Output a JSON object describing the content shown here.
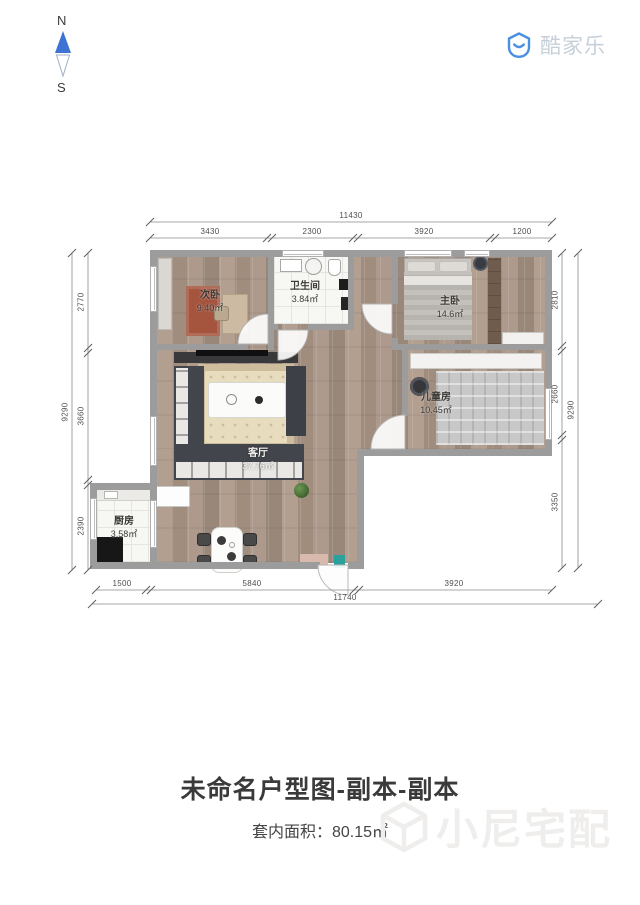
{
  "compass": {
    "north": "N",
    "south": "S"
  },
  "brand": {
    "logo_text": "酷家乐"
  },
  "watermark": {
    "text": "小尼宅配"
  },
  "rooms": {
    "secondary_bedroom": {
      "name": "次卧",
      "area": "9.40㎡"
    },
    "bathroom": {
      "name": "卫生间",
      "area": "3.84㎡"
    },
    "master_bedroom": {
      "name": "主卧",
      "area": "14.6㎡"
    },
    "kids_room": {
      "name": "儿童房",
      "area": "10.45㎡"
    },
    "living_room": {
      "name": "客厅",
      "area": "37.76㎡"
    },
    "kitchen": {
      "name": "厨房",
      "area": "3.58㎡"
    }
  },
  "dimensions": {
    "top": {
      "overall": "11430",
      "segments": [
        "3430",
        "2300",
        "3920",
        "1200"
      ]
    },
    "bottom": {
      "overall": "11740",
      "segments": [
        "1500",
        "5840",
        "3920"
      ]
    },
    "left": {
      "overall": "9290",
      "segments": [
        "2770",
        "3660",
        "2390"
      ]
    },
    "right": {
      "overall": "9290",
      "segments": [
        "2810",
        "2660",
        "3350"
      ]
    }
  },
  "footer": {
    "title": "未命名户型图-副本-副本",
    "area_label": "套内面积：",
    "area_value": "80.15㎡"
  }
}
